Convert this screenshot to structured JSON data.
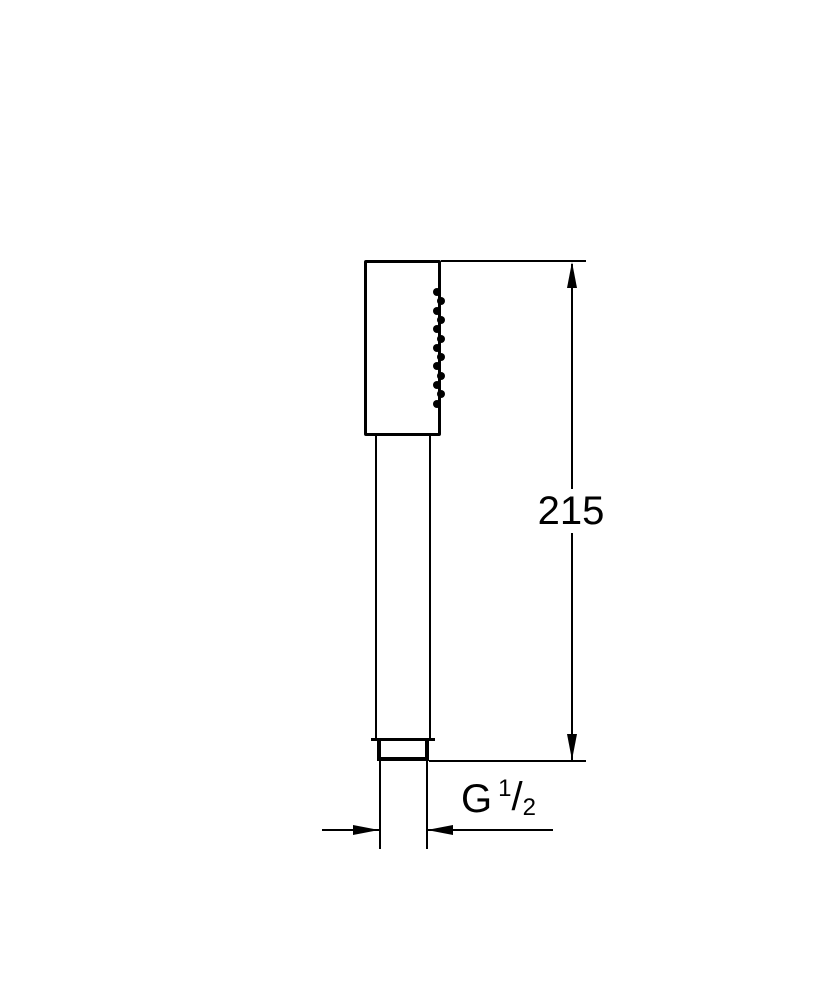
{
  "figure": {
    "type": "technical-drawing",
    "subject": "hand-shower-side-view",
    "background_color": "#ffffff",
    "line_color": "#000000",
    "spray_dot_count": 13,
    "spray_dot_spacing_px": 9.3,
    "height_dimension": {
      "value": "215"
    },
    "thread_dimension": {
      "prefix": "G",
      "numerator": "1",
      "slash": "/",
      "denominator": "2"
    }
  }
}
